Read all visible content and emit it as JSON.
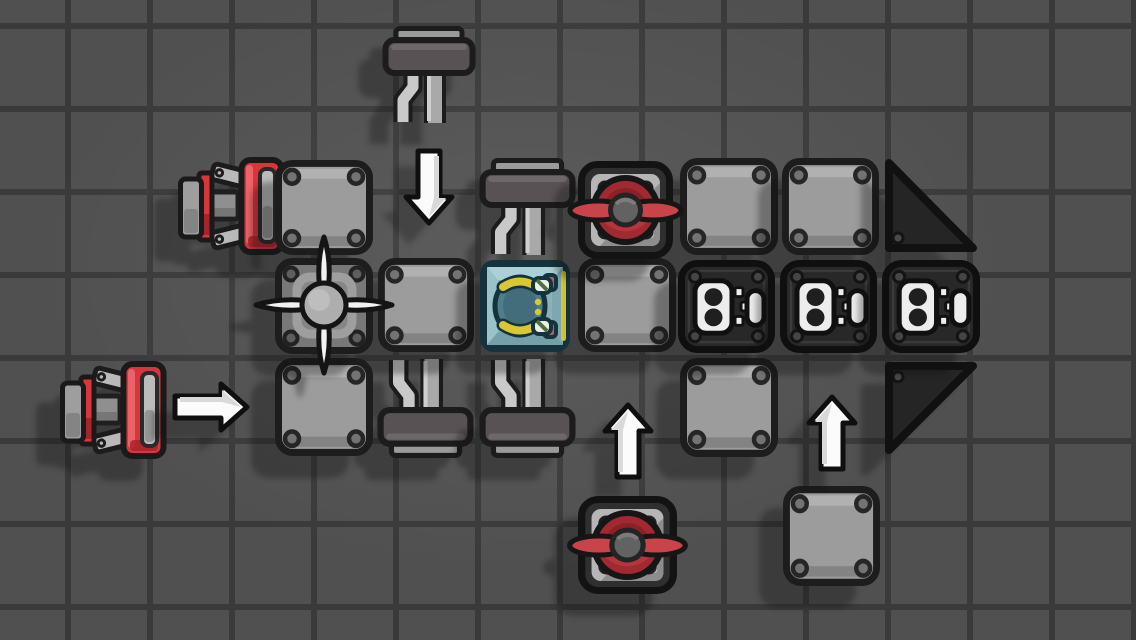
{
  "scene": {
    "width": 1136,
    "height": 640,
    "background_color": "#505050",
    "grid": {
      "line_color": "#3a3a3a",
      "line_width": 6,
      "cell_w": 82,
      "cell_h": 83,
      "offset_x": 65,
      "offset_y": 23
    }
  },
  "palette": {
    "outline": "#161616",
    "plate_fill": "#9c9c9c",
    "plate_border": "#1d1d1d",
    "plate_bevel_light": "rgba(255,255,255,0.22)",
    "plate_bevel_dark": "rgba(0,0,0,0.16)",
    "rivet_fill": "#737373",
    "rivet_ring": "#262626",
    "block_fill": "#282828",
    "block_border": "#0f0f0f",
    "block_inner_line": "#3a3a3a",
    "block_rivet": "#454545",
    "socket_white": "#ededed",
    "socket_hole": "#1f1f1f",
    "triangle_fill": "#252525",
    "triangle_border": "#111111",
    "red_bright": "#d8353d",
    "red_dark": "#a8242b",
    "red_highlight": "#ee6a70",
    "prop_blade": "#c9434b",
    "prop_disc": "#a12931",
    "prop_disc_dark": "#8d1f26",
    "prop_disc_light": "#b5353c",
    "hub_gray": "#626262",
    "hub_ring": "#242424",
    "fan_base": "#787878",
    "fan_frame": "#9e9e9e",
    "fan_inner": "#868686",
    "fan_blade": "#f2f2f2",
    "fan_hub": "#aeaeae",
    "bar_dark": "#595254",
    "bar_thin": "#9a9a9a",
    "leg_light": "#c9c9c9",
    "leg_mid": "#a9a9a9",
    "nozzle_gray": "#9e9e9e",
    "nozzle_dark": "#848484",
    "strut_gray": "#b9b9b9",
    "engine_block": "#8f8f8f",
    "intake_light": "#bcbcbc",
    "intake_dark": "#969696",
    "arrow_white": "#fbfbfb",
    "arrow_shade": "#d9d9d9",
    "arrow_outline": "#0f0f0f",
    "canopy_fill": "#8fb6be",
    "canopy_border": "#14333c",
    "canopy_top": "#abd0d6",
    "canopy_left": "#9cc2c9",
    "canopy_right": "#7ea7b1",
    "canopy_bottom": "#74a0aa",
    "canopy_panel": "#8ab0ba",
    "pilot_body": "#4e7d8b",
    "pilot_body_dark": "#436d7a",
    "pilot_outline": "#15333d",
    "pilot_yellow": "#d9c735",
    "pilot_white": "#ecf1e1",
    "pilot_green": "#4f6f45",
    "pilot_pink": "#b2606e"
  },
  "pieces": [
    {
      "type": "mount",
      "variant": "down",
      "x": 383,
      "y": 26,
      "w": 92,
      "h": 100,
      "name": "suspension-mount-loose-top"
    },
    {
      "type": "mount",
      "variant": "down",
      "x": 480,
      "y": 158,
      "w": 95,
      "h": 100,
      "name": "suspension-mount-above-cockpit"
    },
    {
      "type": "mount",
      "variant": "up",
      "x": 378,
      "y": 356,
      "w": 95,
      "h": 102,
      "name": "suspension-mount-below-left"
    },
    {
      "type": "mount",
      "variant": "up",
      "x": 480,
      "y": 356,
      "w": 95,
      "h": 102,
      "name": "suspension-mount-below-cockpit"
    },
    {
      "type": "thruster",
      "variant": "left",
      "x": 178,
      "y": 156,
      "w": 108,
      "h": 100,
      "name": "red-thruster-top"
    },
    {
      "type": "thruster",
      "variant": "left",
      "x": 60,
      "y": 360,
      "w": 108,
      "h": 100,
      "name": "red-thruster-loose-bottom"
    },
    {
      "type": "plate",
      "x": 275,
      "y": 160,
      "w": 98,
      "h": 95,
      "name": "armor-plate-r1c1"
    },
    {
      "type": "plate",
      "x": 680,
      "y": 158,
      "w": 98,
      "h": 97,
      "name": "armor-plate-r1c5"
    },
    {
      "type": "plate",
      "x": 782,
      "y": 158,
      "w": 97,
      "h": 97,
      "name": "armor-plate-r1c6"
    },
    {
      "type": "plate",
      "x": 378,
      "y": 258,
      "w": 96,
      "h": 94,
      "name": "armor-plate-r2c2"
    },
    {
      "type": "plate",
      "x": 578,
      "y": 258,
      "w": 98,
      "h": 94,
      "name": "armor-plate-r2c4"
    },
    {
      "type": "plate",
      "x": 275,
      "y": 358,
      "w": 98,
      "h": 98,
      "name": "armor-plate-r3c1"
    },
    {
      "type": "plate",
      "x": 680,
      "y": 358,
      "w": 98,
      "h": 99,
      "name": "armor-plate-r3c5"
    },
    {
      "type": "plate",
      "x": 783,
      "y": 486,
      "w": 97,
      "h": 100,
      "name": "armor-plate-r4c6"
    },
    {
      "type": "triangle",
      "variant": "nose-top",
      "x": 882,
      "y": 158,
      "w": 98,
      "h": 97,
      "name": "triangle-armor-top"
    },
    {
      "type": "triangle",
      "variant": "nose-bottom",
      "x": 882,
      "y": 360,
      "w": 98,
      "h": 96,
      "name": "triangle-armor-bottom"
    },
    {
      "type": "block",
      "x": 678,
      "y": 260,
      "w": 97,
      "h": 93,
      "name": "connector-block-1"
    },
    {
      "type": "block",
      "x": 780,
      "y": 260,
      "w": 97,
      "h": 93,
      "name": "connector-block-2"
    },
    {
      "type": "block",
      "x": 882,
      "y": 260,
      "w": 98,
      "h": 93,
      "name": "connector-block-3"
    },
    {
      "type": "fan",
      "x": 275,
      "y": 258,
      "w": 98,
      "h": 96,
      "name": "intake-fan"
    },
    {
      "type": "cockpit",
      "x": 480,
      "y": 260,
      "w": 90,
      "h": 92,
      "name": "cockpit-with-pilot"
    },
    {
      "type": "propeller",
      "x": 578,
      "y": 161,
      "w": 95,
      "h": 98,
      "name": "propeller-engine-top"
    },
    {
      "type": "propeller",
      "x": 578,
      "y": 496,
      "w": 99,
      "h": 98,
      "name": "propeller-engine-bottom"
    },
    {
      "type": "arrow",
      "variant": "down",
      "x": 403,
      "y": 150,
      "w": 52,
      "h": 76,
      "name": "hint-arrow-down"
    },
    {
      "type": "arrow",
      "variant": "right",
      "x": 174,
      "y": 381,
      "w": 76,
      "h": 52,
      "name": "hint-arrow-right"
    },
    {
      "type": "arrow",
      "variant": "up",
      "x": 602,
      "y": 402,
      "w": 52,
      "h": 76,
      "name": "hint-arrow-up-1"
    },
    {
      "type": "arrow",
      "variant": "up",
      "x": 806,
      "y": 394,
      "w": 52,
      "h": 76,
      "name": "hint-arrow-up-2"
    }
  ]
}
